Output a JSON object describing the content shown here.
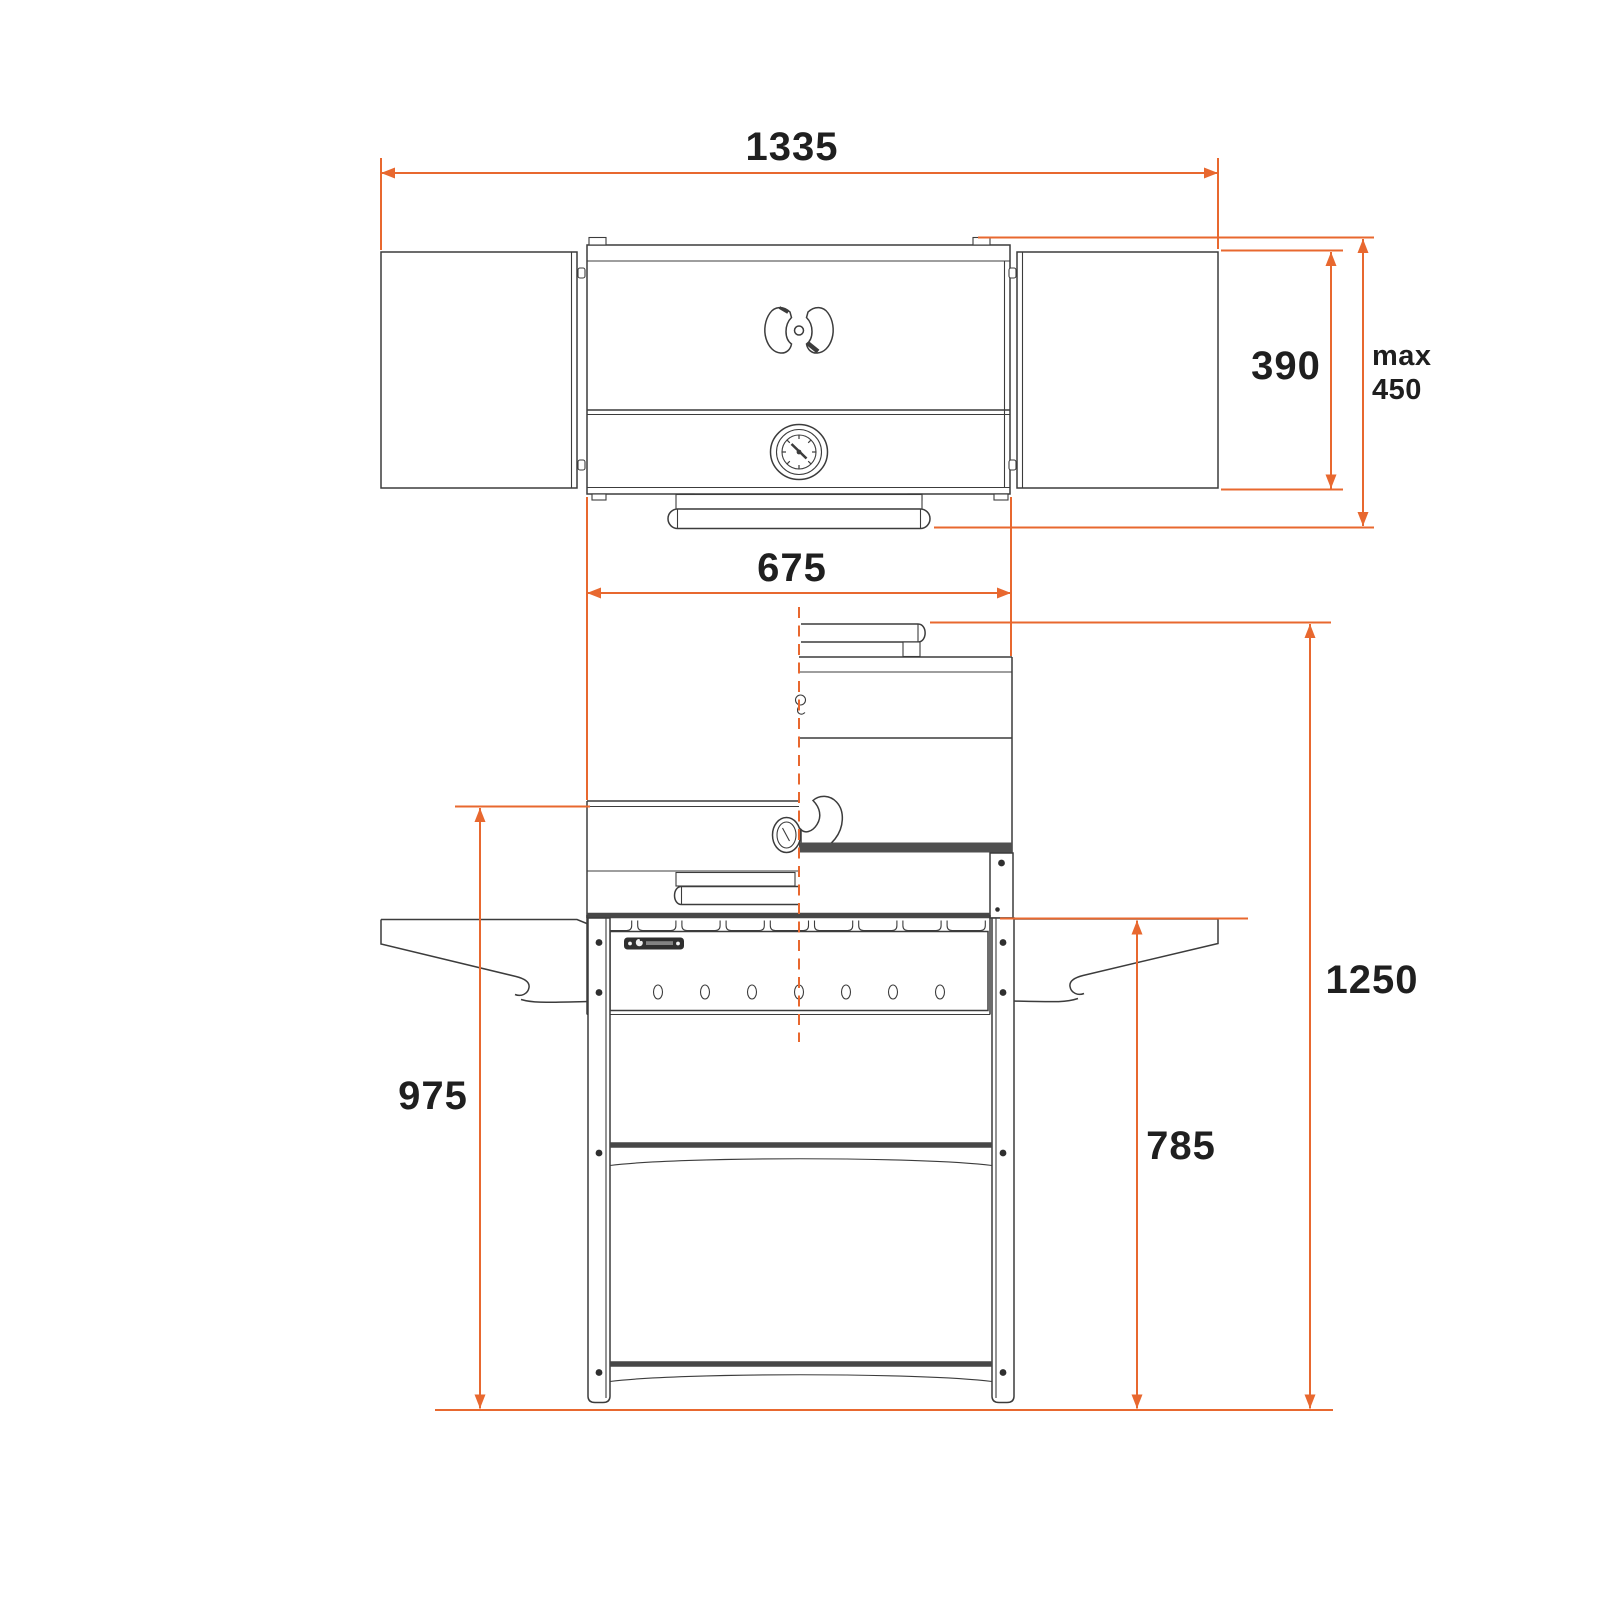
{
  "colors": {
    "accent": "#E8682F",
    "line": "#3C3C3C",
    "line_strong": "#474747",
    "text": "#1F1F1F",
    "background": "#FFFFFF"
  },
  "dimensions": {
    "total_width": "1335",
    "body_depth": "390",
    "max_depth_prefix": "max",
    "max_depth_value": "450",
    "body_width": "675",
    "worktop_height": "975",
    "side_shelf_height": "785",
    "max_height_lid_open": "1250"
  },
  "views": {
    "top_view": "grill top view with side tables open",
    "front_view": "grill front view, left half lid closed, right half lid open"
  }
}
